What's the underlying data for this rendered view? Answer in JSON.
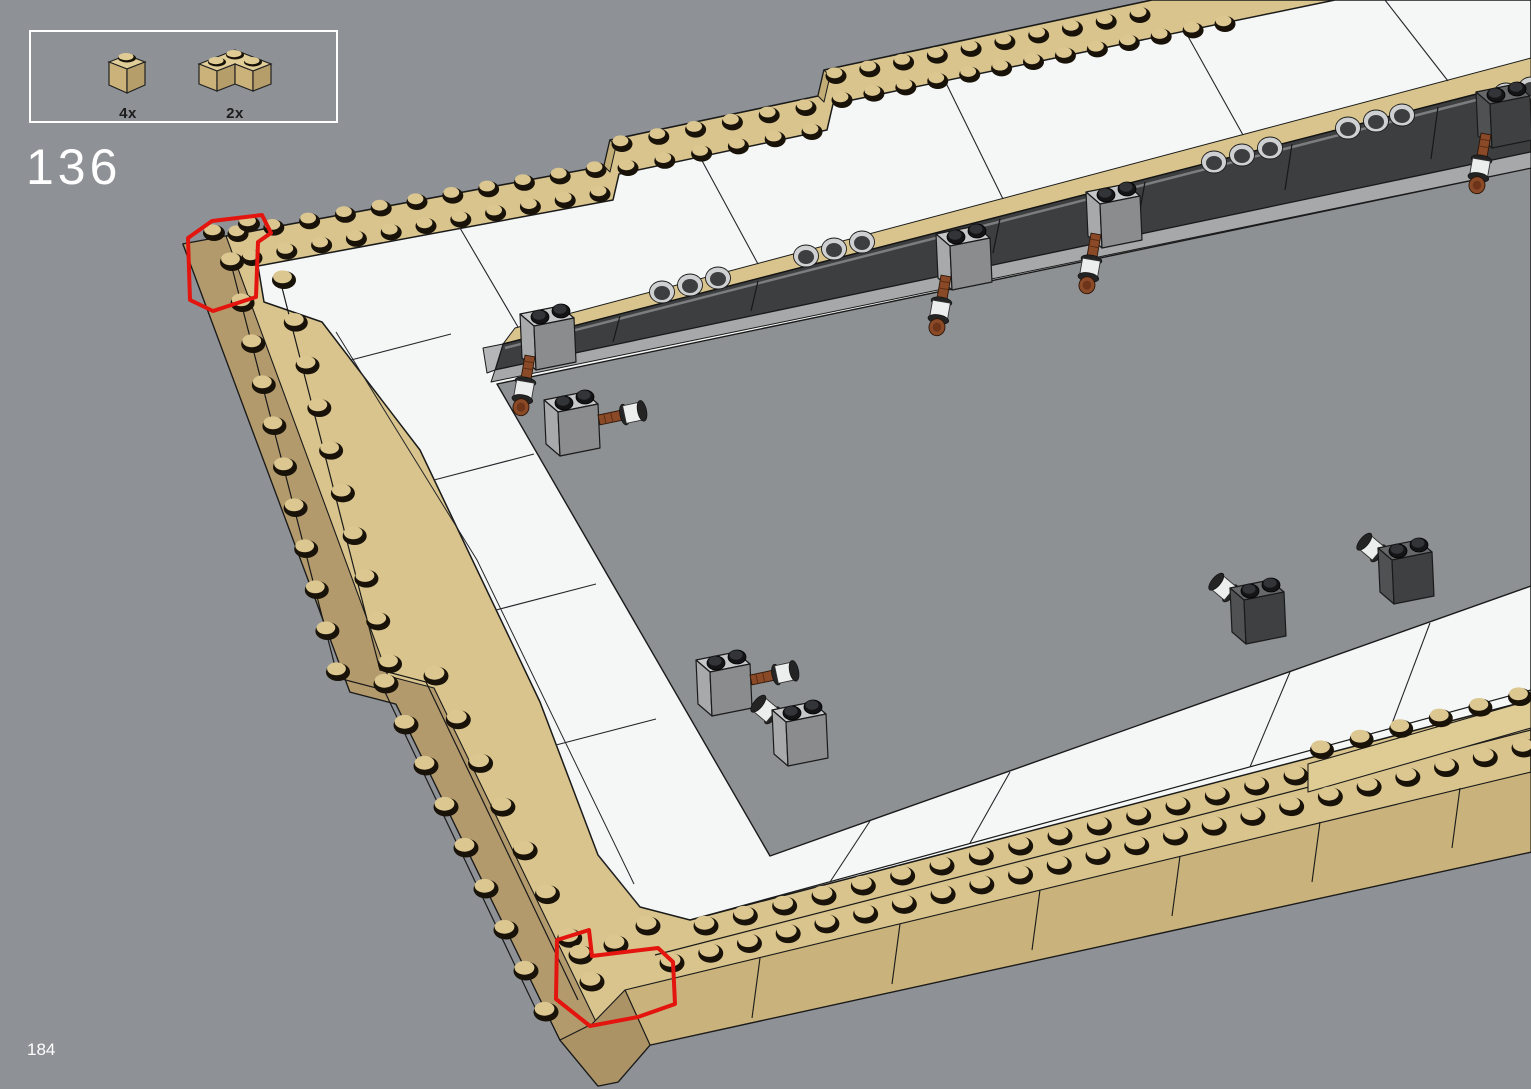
{
  "page": {
    "step_number": "136",
    "page_number": "184",
    "background_color": "#8e9296"
  },
  "parts_callout": {
    "parts": [
      {
        "count": "4x",
        "name": "tan 1x1 brick"
      },
      {
        "count": "2x",
        "name": "tan 2x2 corner brick"
      }
    ]
  },
  "illustration": {
    "description": "Isometric view of a large rectangular tan brick frame with a white tile inner border, a dark technic beam with round pin holes along the top inner edge, gray technic pin bricks with brown axle pins attached around the opening, and red outlines marking where the new corner bricks are placed at the top-left and bottom-left corners",
    "highlight_color": "#e3150e",
    "colors": {
      "tan": "#d8c48c",
      "tan_light": "#e0cd97",
      "tan_mid": "#cbb27b",
      "tan_shadow": "#b29a6c",
      "white_tile": "#f5f7f7",
      "beam_dark": "#3d3e40",
      "base_gray": "#a6a8aa",
      "technic_gray": "#c6c7c8",
      "technic_dark_gray": "#66686a",
      "pin_brown": "#8a4a28",
      "pin_silver": "#eceded"
    }
  }
}
